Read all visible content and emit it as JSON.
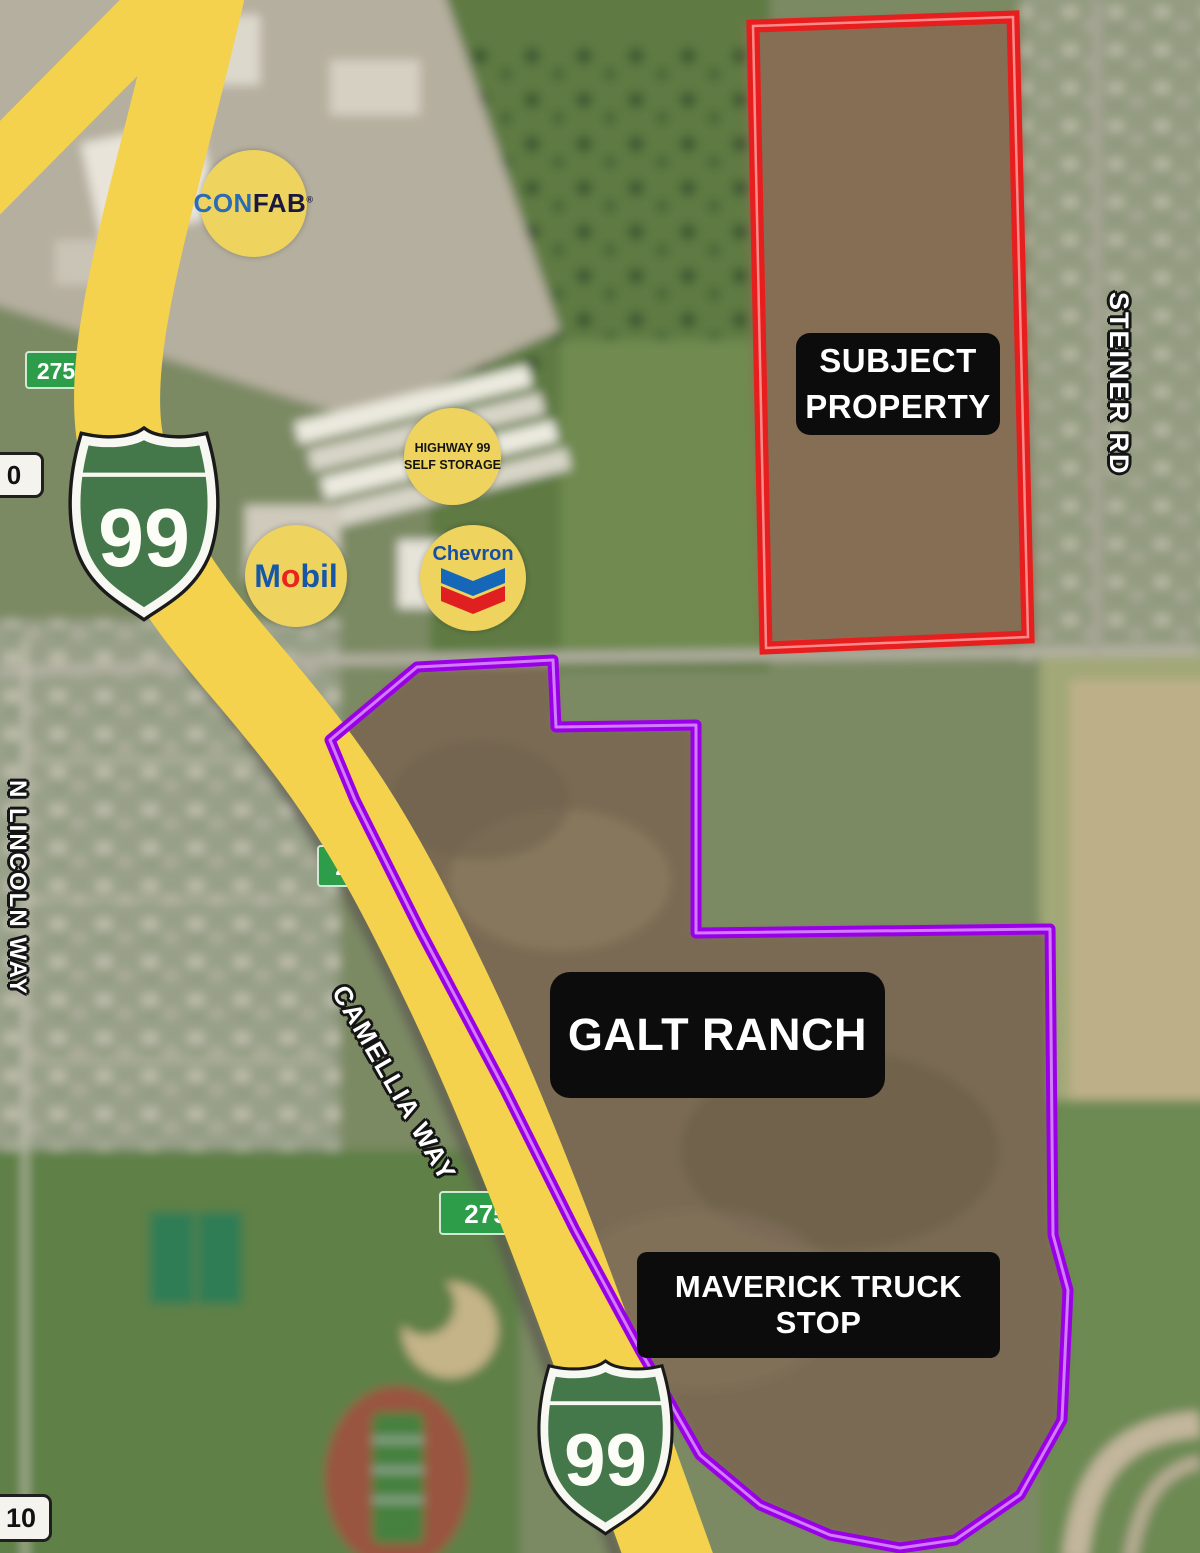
{
  "annotations": {
    "subject_property": {
      "line1": "SUBJECT",
      "line2": "PROPERTY"
    },
    "galt_ranch": "GALT RANCH",
    "maverick": "MAVERICK TRUCK STOP"
  },
  "roads": {
    "steiner": "STEINER RD",
    "lincoln": "N LINCOLN WAY",
    "camellia": "CAMELLIA WAY"
  },
  "shields": {
    "top": "99",
    "bottom": "99"
  },
  "exit_signs": {
    "north": "275",
    "mid": "275A",
    "south": "275"
  },
  "mile_markers": {
    "north": "0",
    "south": "10"
  },
  "badges": {
    "confab": {
      "part1": "CON",
      "part2": "FAB",
      "reg": "®"
    },
    "self_storage": {
      "line1": "HIGHWAY 99",
      "line2": "SELF STORAGE"
    },
    "mobil": {
      "m": "M",
      "o": "o",
      "bil": "bil"
    },
    "chevron": {
      "label": "Chevron"
    }
  },
  "colors": {
    "subject_boundary": "#e61e1e",
    "galt_boundary": "#9a00e6",
    "highway_yellow": "#f4d24d",
    "shield_green": "#44774a",
    "exit_sign_green": "#2e9d4a",
    "badge_yellow": "#eed35e",
    "label_bg": "#0c0c0c"
  }
}
